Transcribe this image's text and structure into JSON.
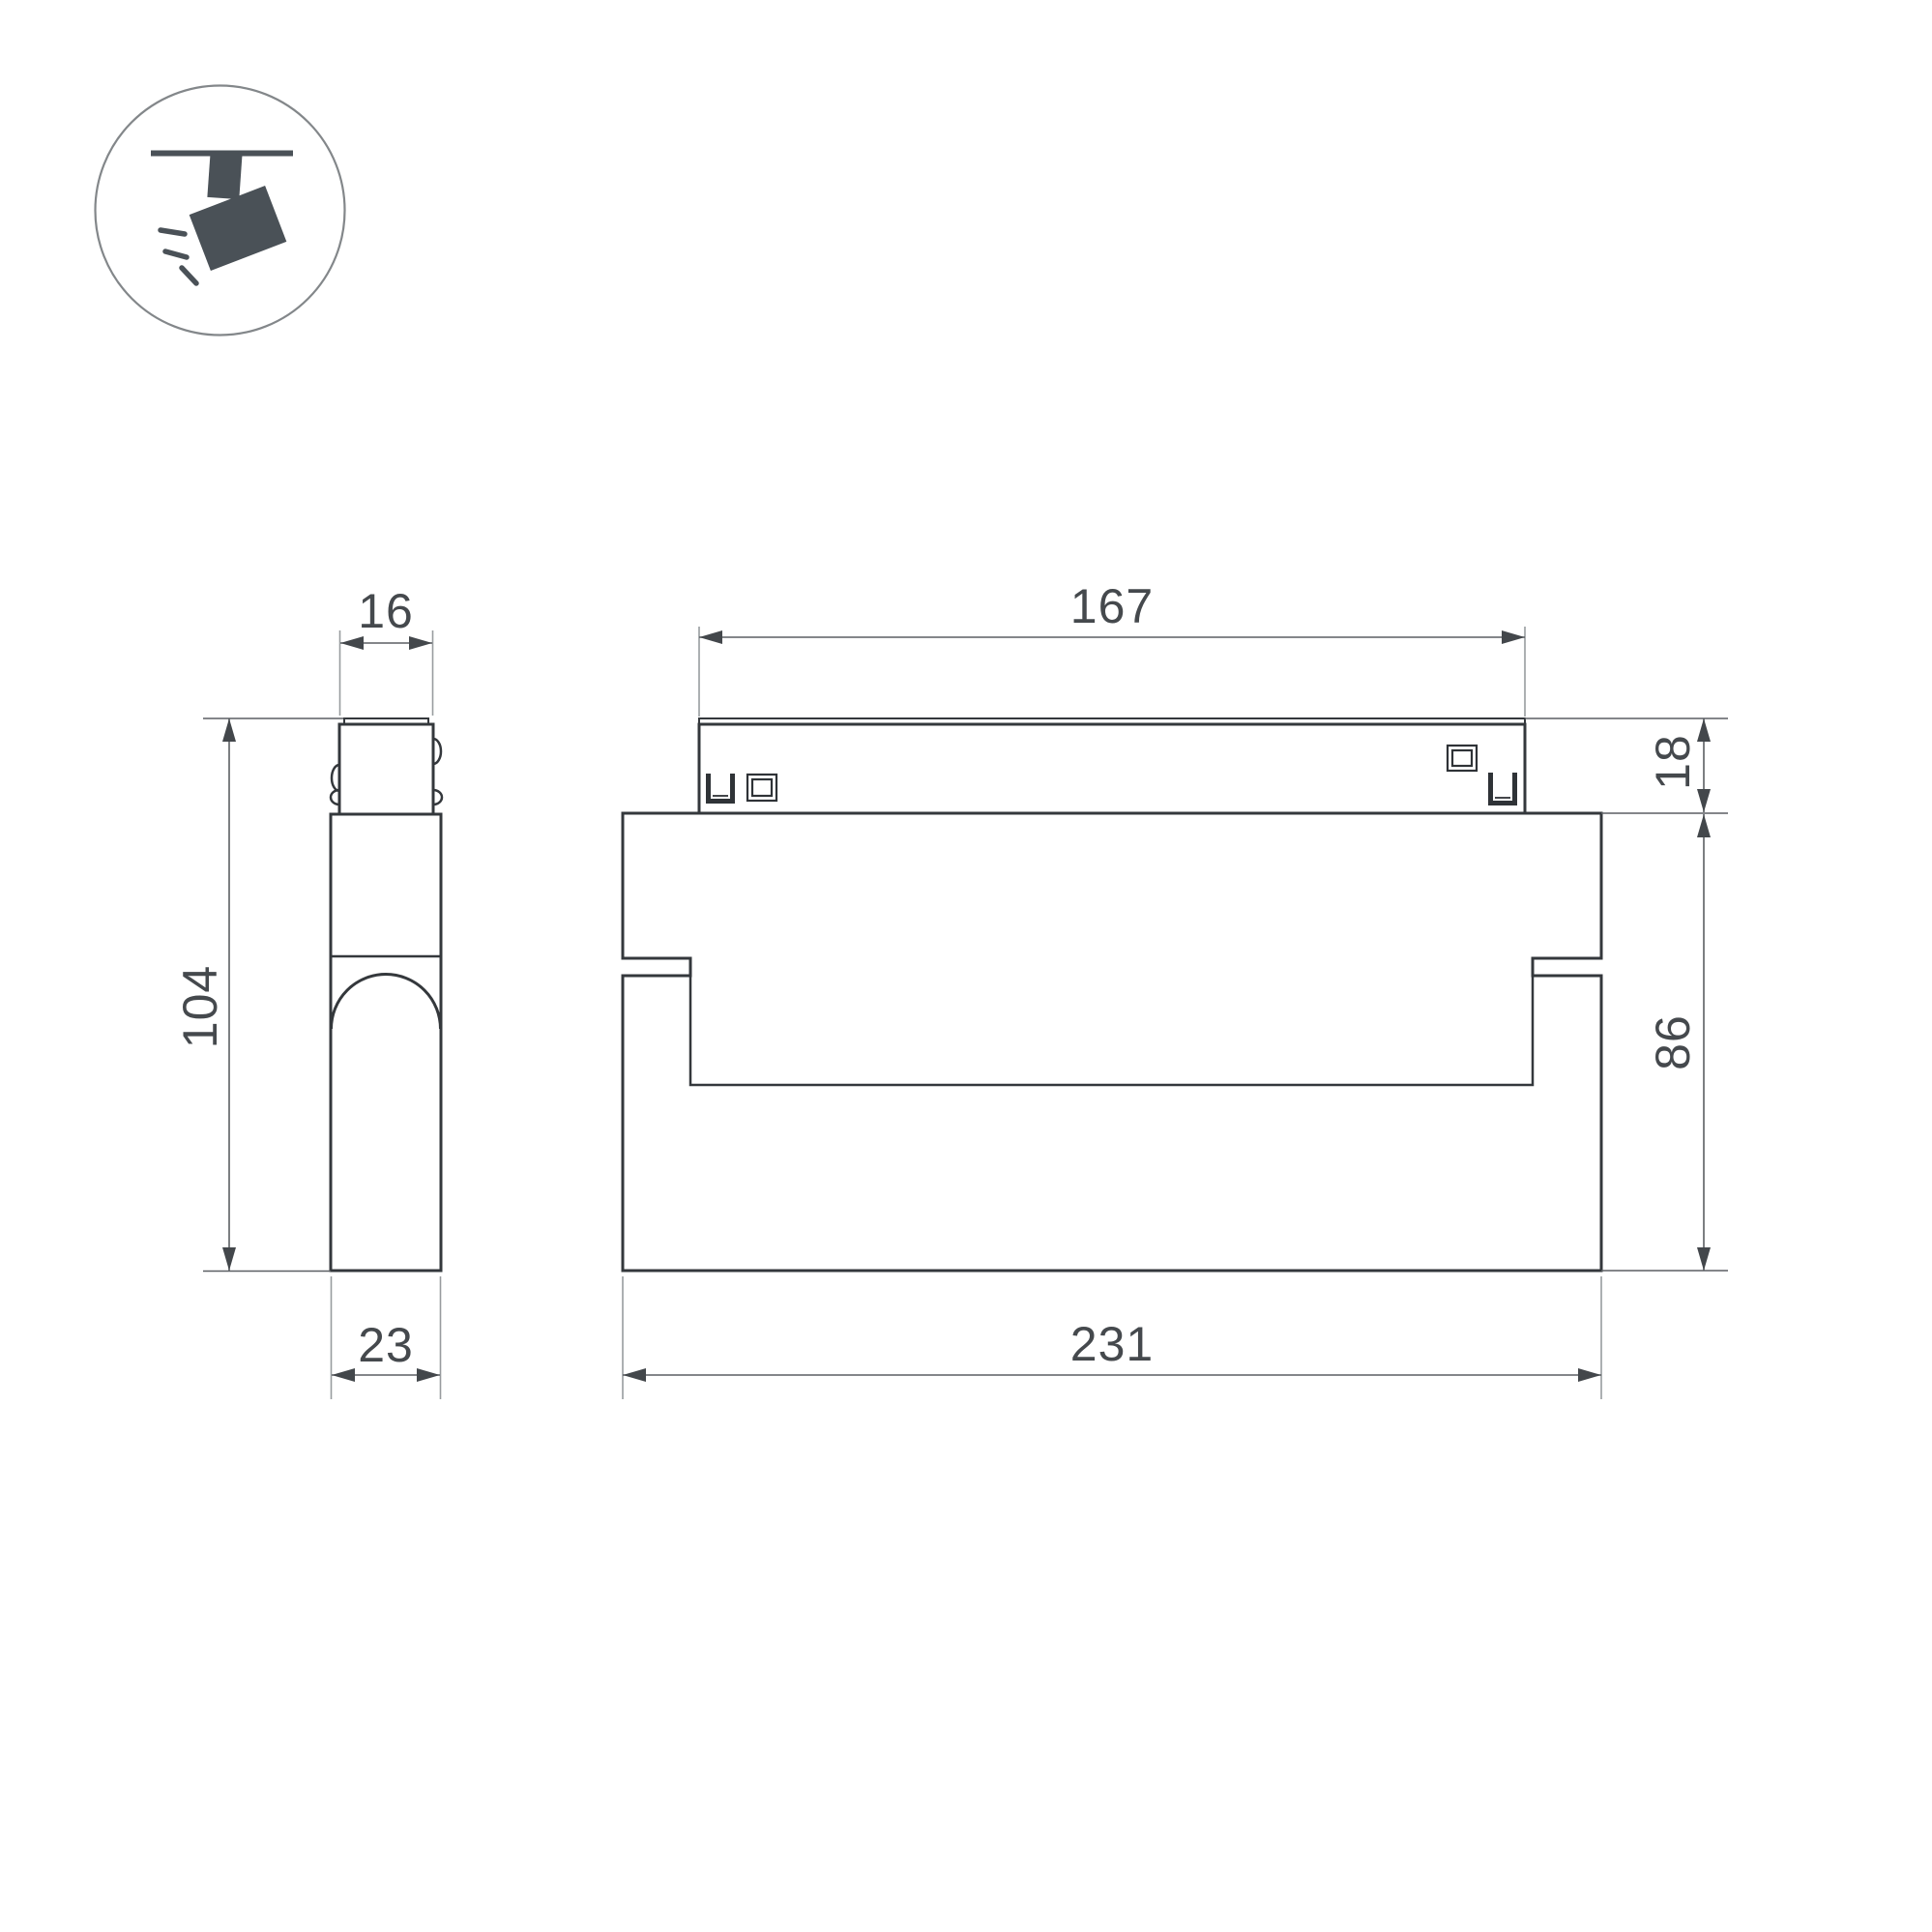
{
  "drawing": {
    "title": "track-spotlight-dimension-drawing",
    "icon": {
      "name": "track-spotlight-icon"
    },
    "side_view": {
      "connector_width": "16",
      "overall_height": "104",
      "body_depth": "23"
    },
    "front_view": {
      "track_connector_length": "167",
      "track_connector_height": "18",
      "body_height": "86",
      "body_length": "231"
    }
  },
  "colors": {
    "background": "#ffffff",
    "part_outline": "#34383c",
    "dimension_line": "#5b5f63",
    "extension_line": "#989c9f",
    "dimension_text": "#45494d",
    "icon_fill": "#4a5157",
    "icon_circle": "#83878a"
  }
}
